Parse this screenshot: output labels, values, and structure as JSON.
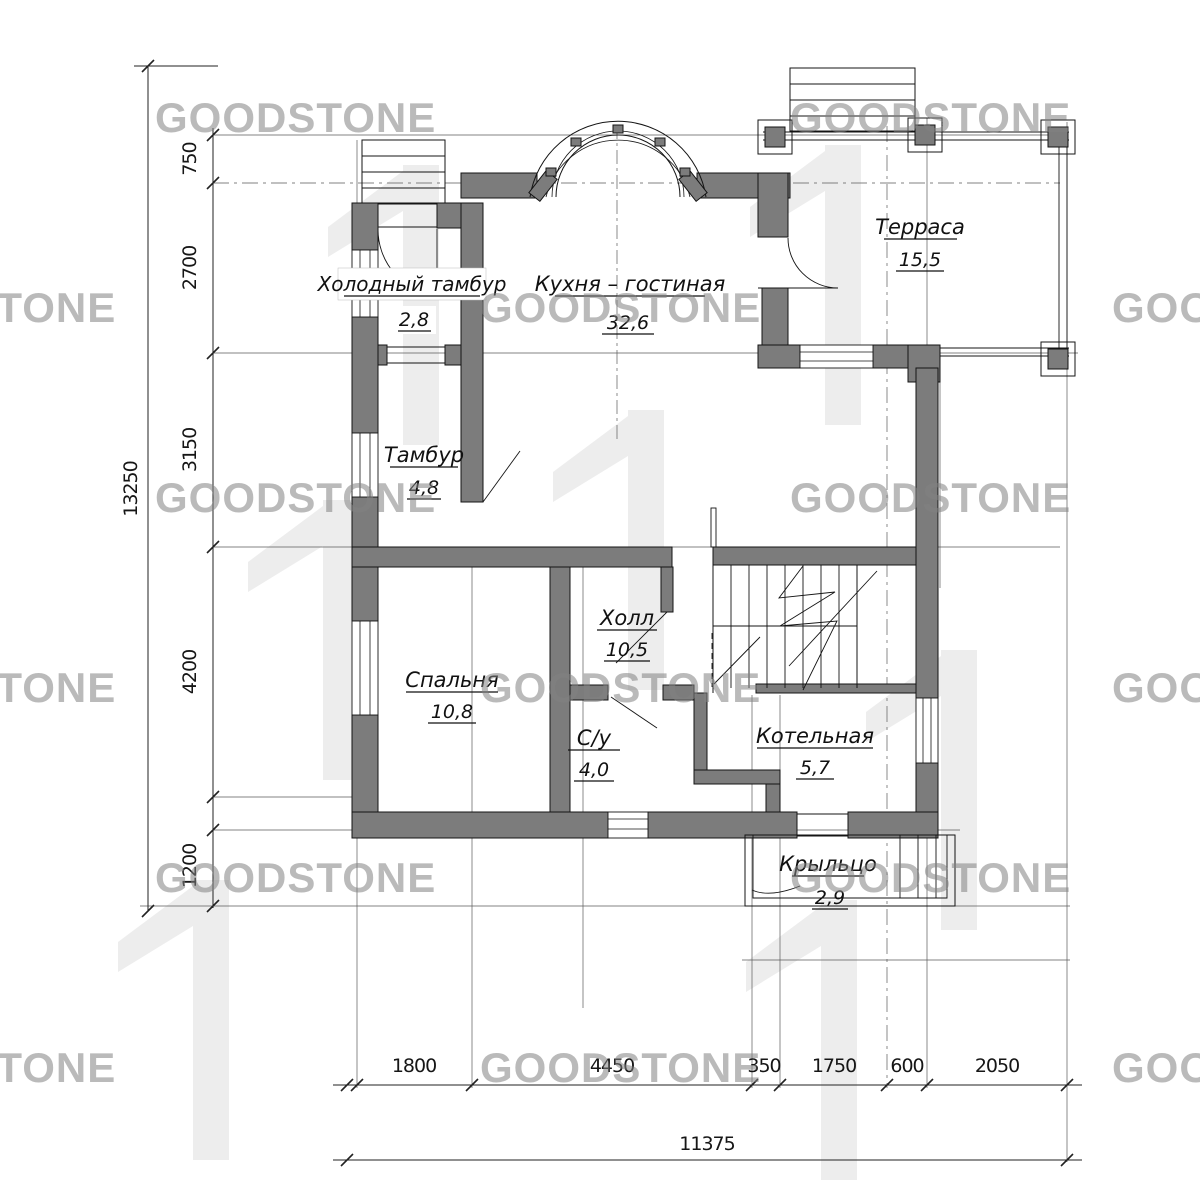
{
  "watermark": {
    "text": "GOODSTONE"
  },
  "plan": {
    "title": "План 1 этажа",
    "rooms": [
      {
        "name": "Холодный тамбур",
        "area": "2,8"
      },
      {
        "name": "Кухня – гостиная",
        "area": "32,6"
      },
      {
        "name": "Терраса",
        "area": "15,5"
      },
      {
        "name": "Тамбур",
        "area": "4,8"
      },
      {
        "name": "Холл",
        "area": "10,5"
      },
      {
        "name": "Спальня",
        "area": "10,8"
      },
      {
        "name": "С/у",
        "area": "4,0"
      },
      {
        "name": "Котельная",
        "area": "5,7"
      },
      {
        "name": "Крыльцо",
        "area": "2,9"
      }
    ],
    "dimensions": {
      "left": [
        "750",
        "2700",
        "3150",
        "4200",
        "1200"
      ],
      "left_total": "13250",
      "bottom": [
        "1800",
        "4450",
        "350",
        "1750",
        "600",
        "2050"
      ],
      "bottom_total": "11375"
    },
    "colors": {
      "wall": "#7c7c7c",
      "line": "#141414",
      "watermark": "#8c8c8c",
      "logo": "#ededed"
    }
  }
}
